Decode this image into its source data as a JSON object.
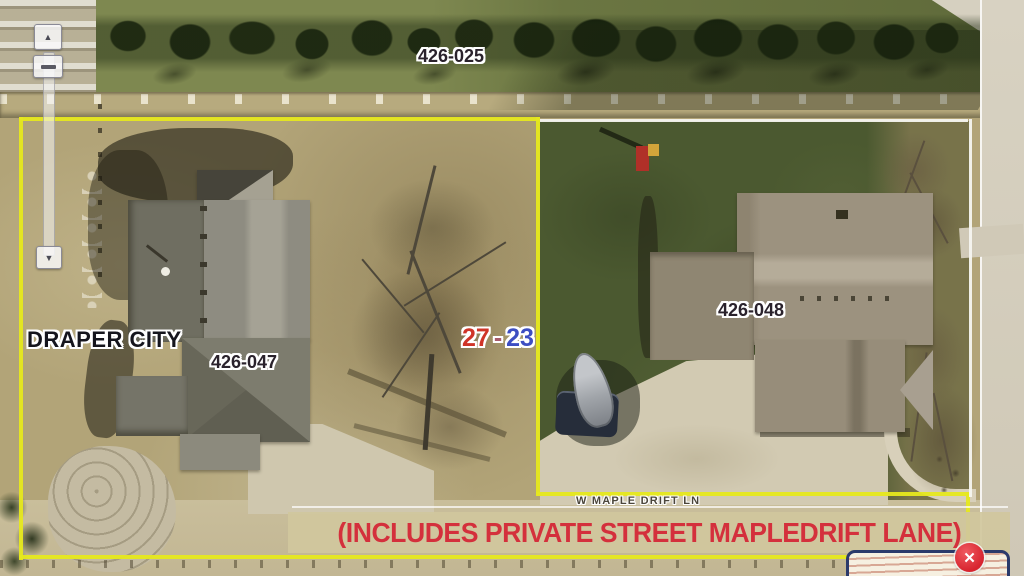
{
  "labels": {
    "parcel_north": "426-025",
    "parcel_west": "426-047",
    "parcel_east": "426-048",
    "city": "DRAPER CITY",
    "section_left": "27",
    "section_separator": "-",
    "section_right": "23",
    "street": "W MAPLE DRIFT LN",
    "banner": "(INCLUDES PRIVATE STREET MAPLEDRIFT LANE)"
  },
  "colors": {
    "selected_parcel_boundary": "#e6e81e",
    "adjacent_parcel_boundary": "#f6f6f0",
    "banner_text": "#d4303c",
    "banner_background": "#d0c79d",
    "section_left_color": "#cf3428",
    "section_right_color": "#3d4ec2",
    "close_button": "#d8242f"
  },
  "controls": {
    "zoom_in_glyph": "▲",
    "zoom_out_glyph": "▼",
    "close_glyph": "✕"
  }
}
